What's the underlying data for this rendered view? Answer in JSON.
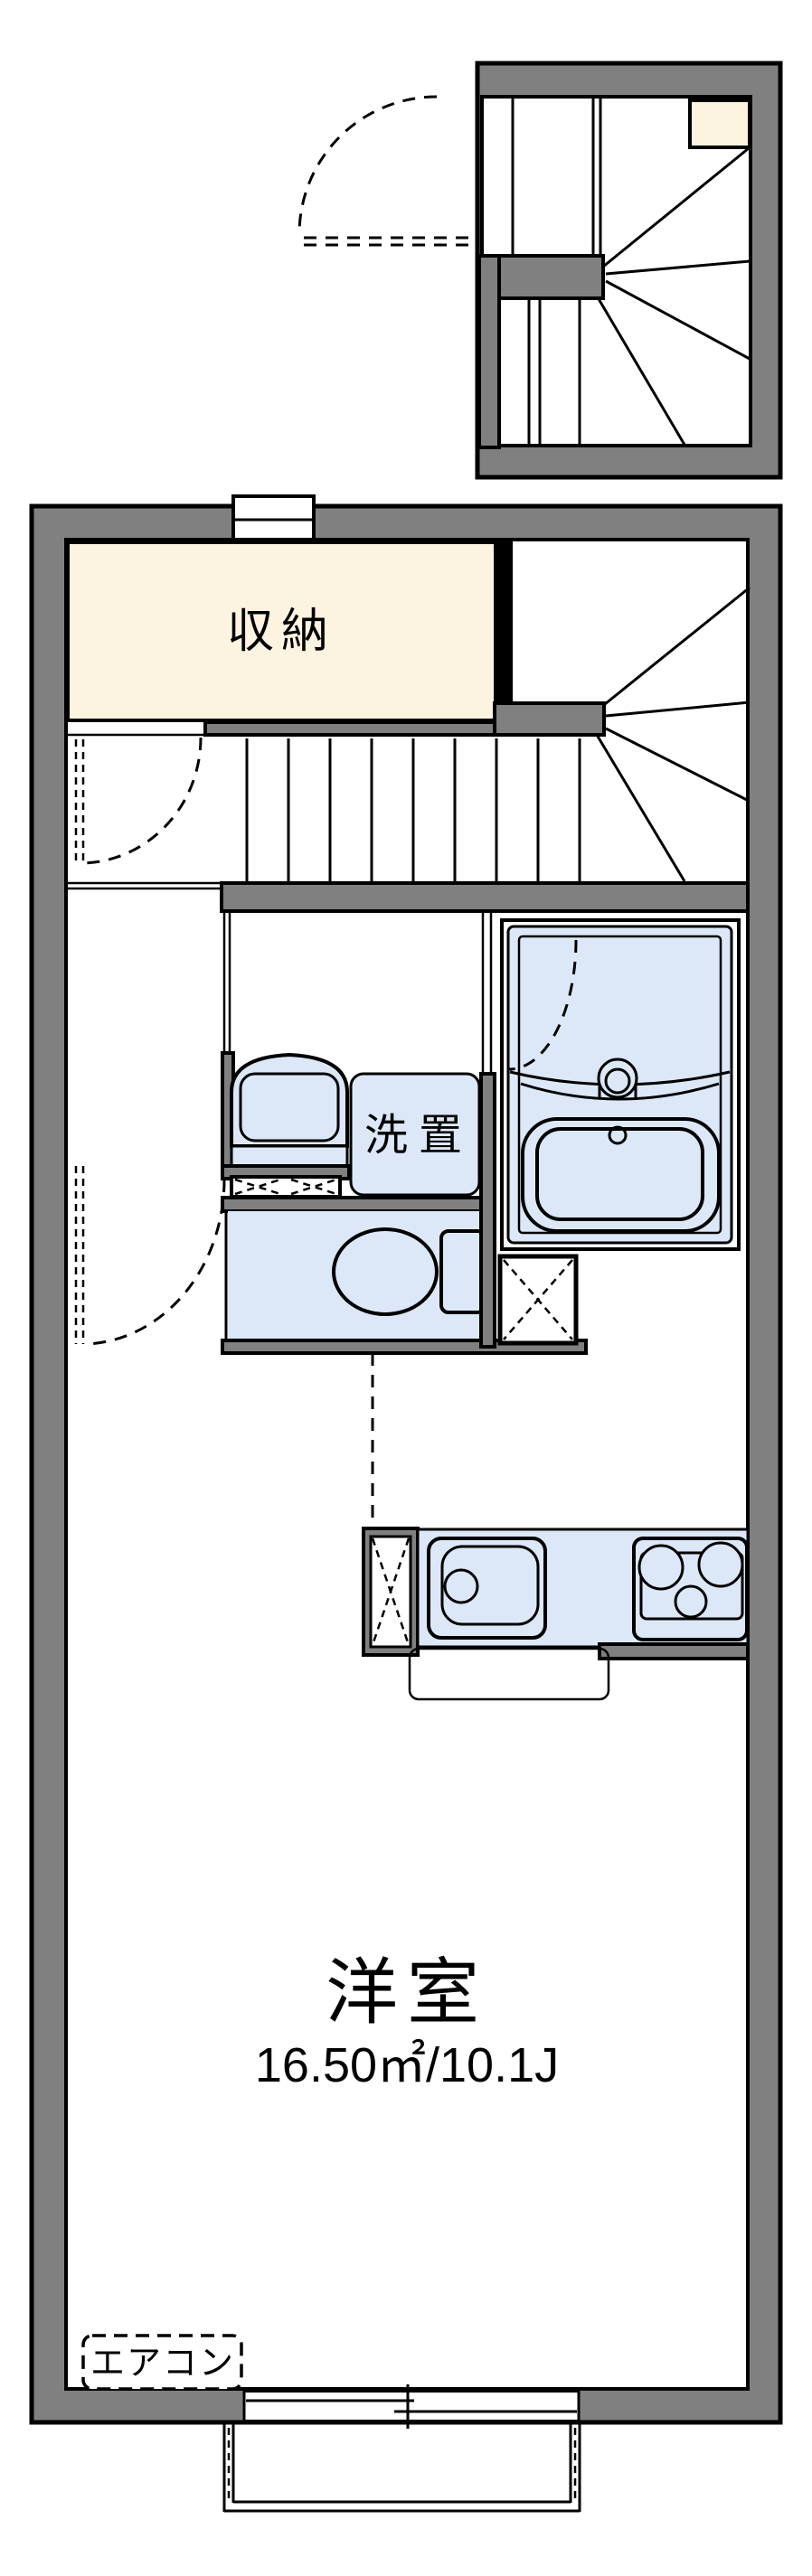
{
  "labels": {
    "storage": "収納",
    "washer_place": "洗置",
    "main_room": "洋室",
    "main_room_area": "16.50㎡/10.1J",
    "air_conditioner": "エアコン"
  },
  "colors": {
    "wall": "#808080",
    "line": "#000000",
    "storage": "#fcf3e0",
    "fixture": "#dce8f7",
    "bg": "#ffffff"
  },
  "fixtures": [
    "winding-staircase",
    "straight-staircase",
    "storage-closet",
    "washbasin",
    "washing-machine-space",
    "toilet",
    "bathtub",
    "bath-faucet",
    "kitchen-sink",
    "gas-stove",
    "refrigerator-space",
    "sliding-window",
    "balcony",
    "air-conditioner-space",
    "door-swings"
  ]
}
